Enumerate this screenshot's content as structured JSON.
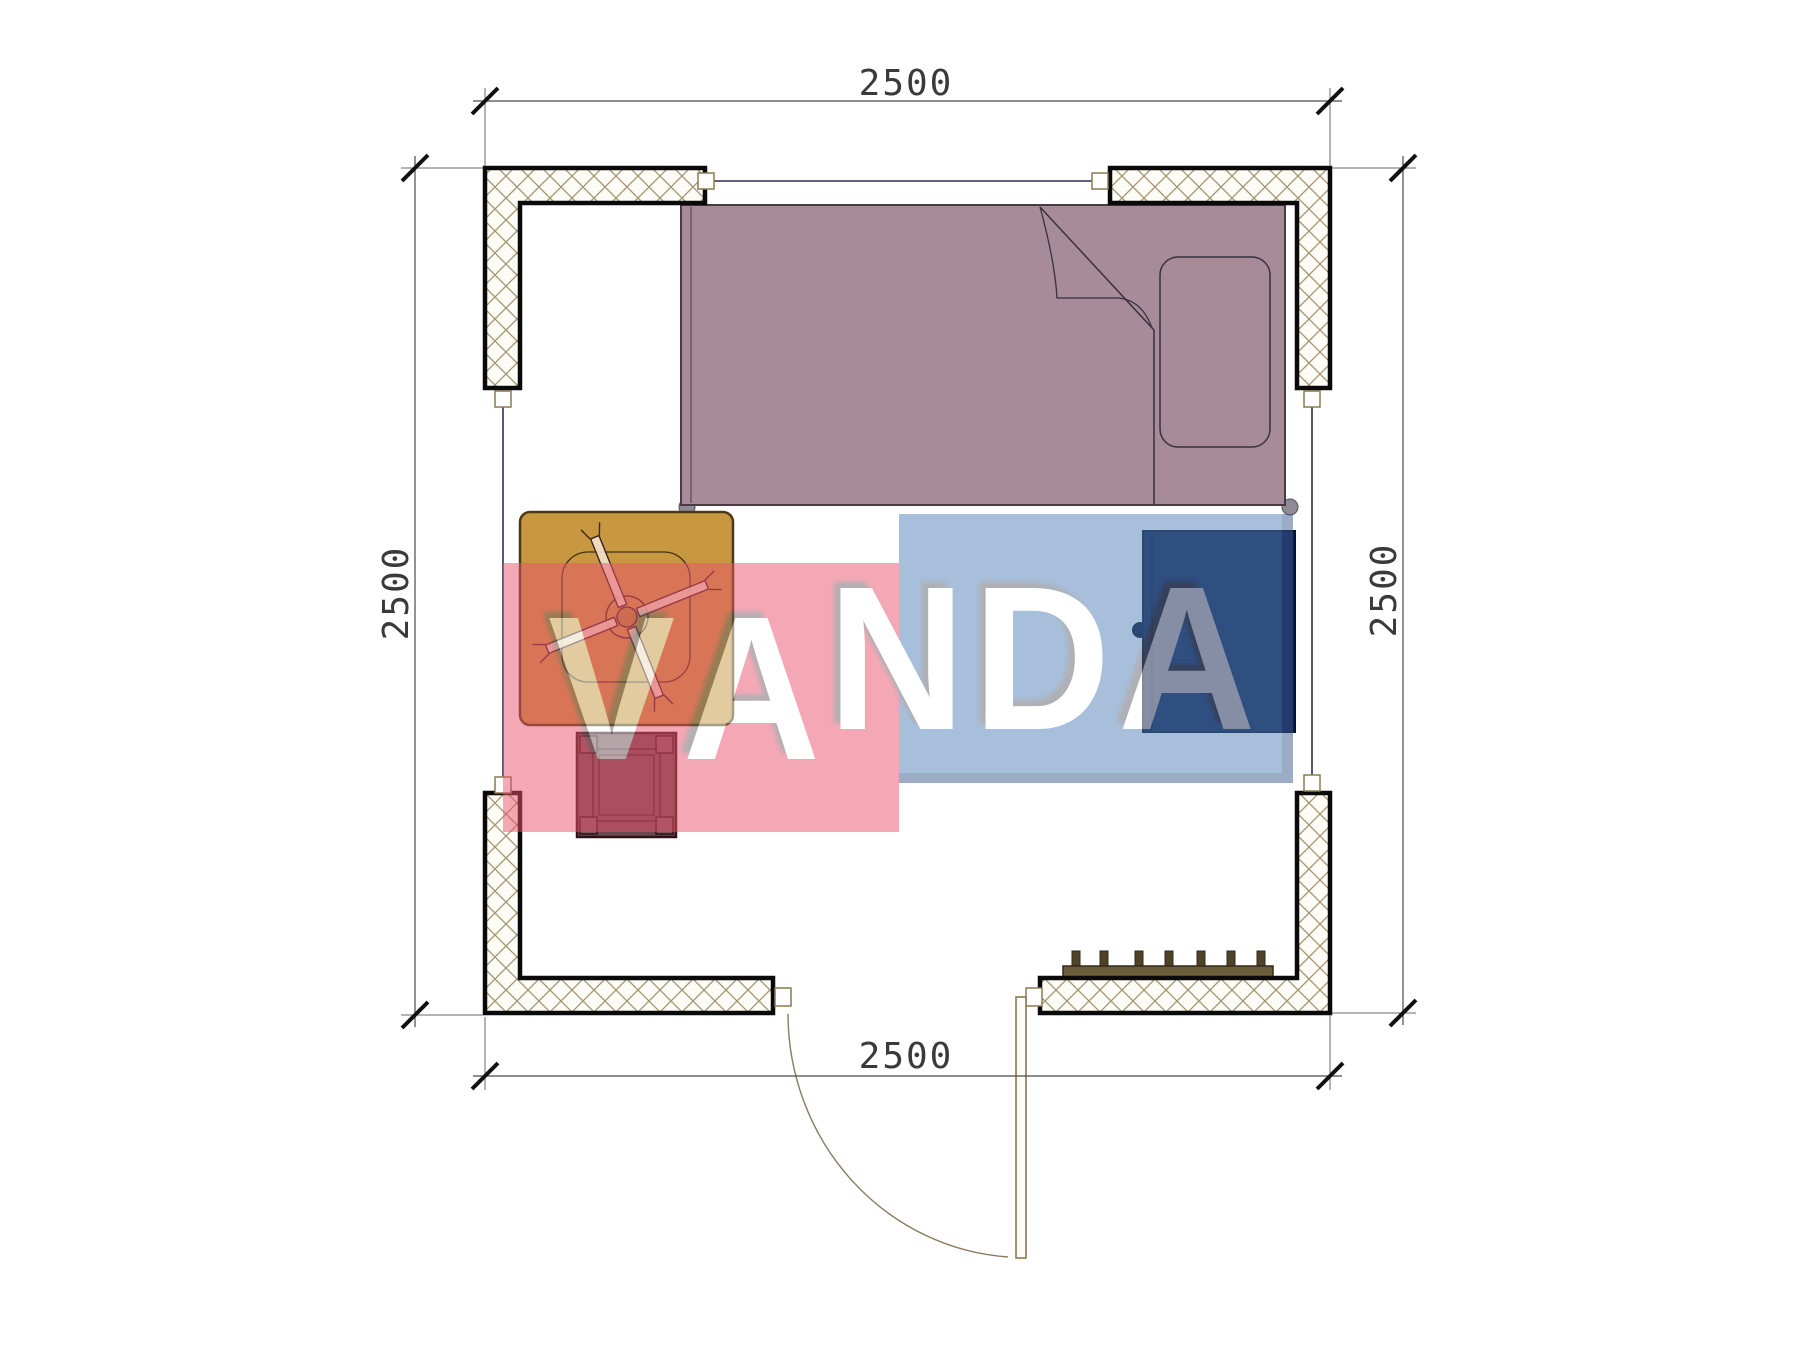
{
  "drawing": {
    "type": "floor-plan",
    "dimensions": {
      "top": "2500",
      "bottom": "2500",
      "left": "2500",
      "right": "2500"
    },
    "watermark": {
      "text": "VANDA",
      "red_block_color": "#eb546e",
      "blue_block_color": "#5381b9",
      "opacity": 0.5
    },
    "colors": {
      "bed": "#a78b98",
      "table": "#c79840",
      "stool": "#6a4a50",
      "cabinet": "#0b1d4a",
      "radiator": "#6b5c3a",
      "door_frame": "#8a7a50",
      "window_line": "#2e2e52",
      "wall_hatch": "#a4946e",
      "dimension_line": "#444444"
    },
    "furniture": [
      "bed",
      "pillow",
      "blanket-fold",
      "table",
      "fan-cross",
      "stool",
      "cabinet",
      "radiator",
      "door",
      "windows"
    ]
  }
}
